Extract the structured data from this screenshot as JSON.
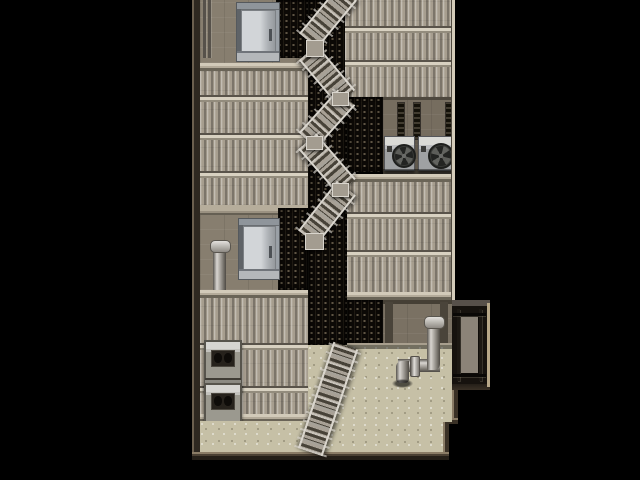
{
  "scene": {
    "type": "game-map-screenshot",
    "view": "top-down-tilemap",
    "setting": "building-rooftop-with-fire-escape-stairs",
    "background_color": "#000000",
    "palette": {
      "bg": "#000000",
      "roof": "#a79e8f",
      "seamLight": "#d8d1c1",
      "seamDark": "#59534a",
      "wall": "#877e6f",
      "wallLight": "#b6ad9b",
      "wallDark": "#655f53",
      "grating": "#0c0906",
      "gratingDot": "#6f6450",
      "floor": "#c6c0a6",
      "borderDark": "#3a3126",
      "borderLight": "#8a7c66",
      "railing": "#d9d5cd",
      "tread": "#a8a196",
      "treadDark": "#474238",
      "fanDark": "#232422",
      "doorMetal": "#c9cdd0",
      "pipeLight": "#d9d6d1"
    },
    "regions": [
      {
        "name": "north-wall-band"
      },
      {
        "name": "upper-left-roof"
      },
      {
        "name": "upper-right-roof"
      },
      {
        "name": "central-stair-shaft"
      },
      {
        "name": "east-ac-wall"
      },
      {
        "name": "mid-wall-band"
      },
      {
        "name": "lower-left-roof"
      },
      {
        "name": "south-wall-band"
      },
      {
        "name": "ground-floor-courtyard"
      }
    ],
    "objects": [
      {
        "name": "metal-door-north",
        "count": 1
      },
      {
        "name": "metal-door-mid",
        "count": 1
      },
      {
        "name": "zigzag-staircase",
        "flights": 6
      },
      {
        "name": "ac-fan-unit",
        "count": 2
      },
      {
        "name": "rooftop-machine-box",
        "count": 2
      },
      {
        "name": "standpipe-with-cap",
        "count": 1
      },
      {
        "name": "drain-pipe-assembly",
        "count": 1
      },
      {
        "name": "metal-gate-panel",
        "count": 1
      },
      {
        "name": "vent-grating-section",
        "count": 5
      },
      {
        "name": "wall-conduit",
        "count": 2
      }
    ]
  }
}
